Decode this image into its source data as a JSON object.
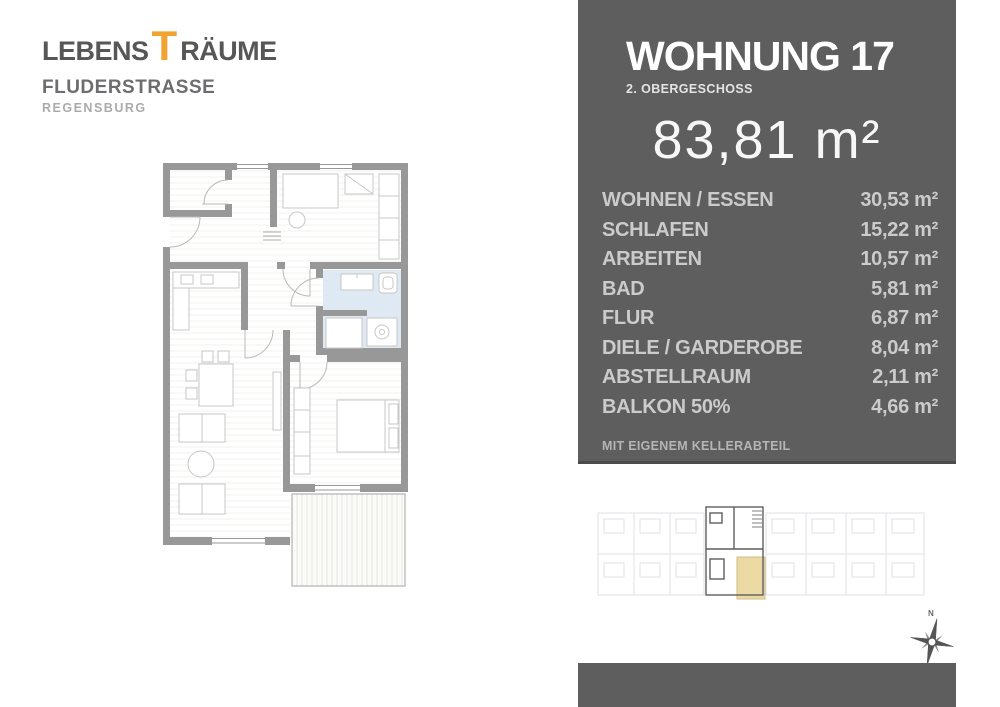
{
  "logo": {
    "line1_left": "LEBENS",
    "line1_accent": "T",
    "line1_right": "RÄUME",
    "line2": "FLUDERSTRASSE",
    "line3": "REGENSBURG",
    "accent_color": "#f2a432",
    "text_color": "#575757"
  },
  "panel": {
    "background": "#5e5e5e",
    "title": "WOHNUNG 17",
    "subtitle": "2. OBERGESCHOSS",
    "total_area": "83,81 m²",
    "rooms": [
      {
        "label": "WOHNEN / ESSEN",
        "value": "30,53 m²"
      },
      {
        "label": "SCHLAFEN",
        "value": "15,22 m²"
      },
      {
        "label": "ARBEITEN",
        "value": "10,57 m²"
      },
      {
        "label": "BAD",
        "value": "5,81 m²"
      },
      {
        "label": "FLUR",
        "value": "6,87 m²"
      },
      {
        "label": "DIELE / GARDEROBE",
        "value": "8,04 m²"
      },
      {
        "label": "ABSTELLRAUM",
        "value": "2,11 m²"
      },
      {
        "label": "BALKON 50%",
        "value": "4,66 m²"
      }
    ],
    "note": "MIT EIGENEM KELLERABTEIL"
  },
  "floorplan": {
    "wall_color": "#989898",
    "bath_floor_color": "#dfe9f3",
    "balcony_stripe_color": "#e6e6e3"
  },
  "overview": {
    "highlight_color": "#5f5f5f",
    "balcony_color": "#ecdaa4"
  },
  "compass": {
    "label": "N"
  }
}
